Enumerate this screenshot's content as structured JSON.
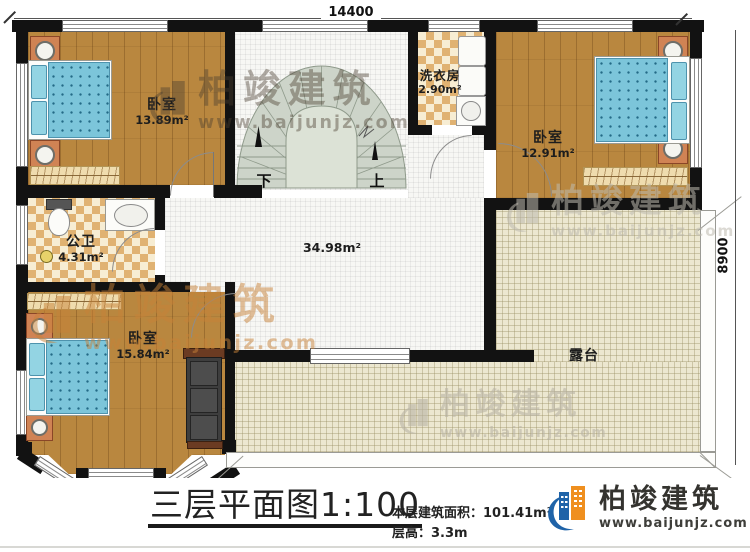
{
  "plan": {
    "dim_top": "14400",
    "dim_right": "8900",
    "rooms": {
      "bedroom_tl": {
        "label": "卧室",
        "area": "13.89m²"
      },
      "laundry": {
        "label": "洗衣房",
        "area": "2.90m²"
      },
      "bedroom_tr": {
        "label": "卧室",
        "area": "12.91m²"
      },
      "bathroom": {
        "label": "公卫",
        "area": "4.31m²"
      },
      "bedroom_bl": {
        "label": "卧室",
        "area": "15.84m²"
      },
      "hall": {
        "area": "34.98m²"
      },
      "terrace": {
        "label": "露台"
      }
    },
    "stairs": {
      "down": "下",
      "up": "上"
    }
  },
  "titleblock": {
    "title": "三层平面图",
    "scale": "1:100",
    "area_label": "本层建筑面积：",
    "area_value": "101.41m²",
    "height_label": "层高：",
    "height_value": "3.3m"
  },
  "brand": {
    "name": "柏竣建筑",
    "url": "www.baijunjz.com"
  },
  "watermark": {
    "name": "柏竣建筑",
    "url": "www.baijunjz.com"
  },
  "colors": {
    "brand_blue": "#1f63a8",
    "brand_orange": "#ef8f1f",
    "wall": "#121212",
    "wood": "#b9873f",
    "mattress": "#7cc5da",
    "stair_fill": "#cdd4c9",
    "tile": "#e0b272",
    "terrace": "#ece7d0"
  }
}
